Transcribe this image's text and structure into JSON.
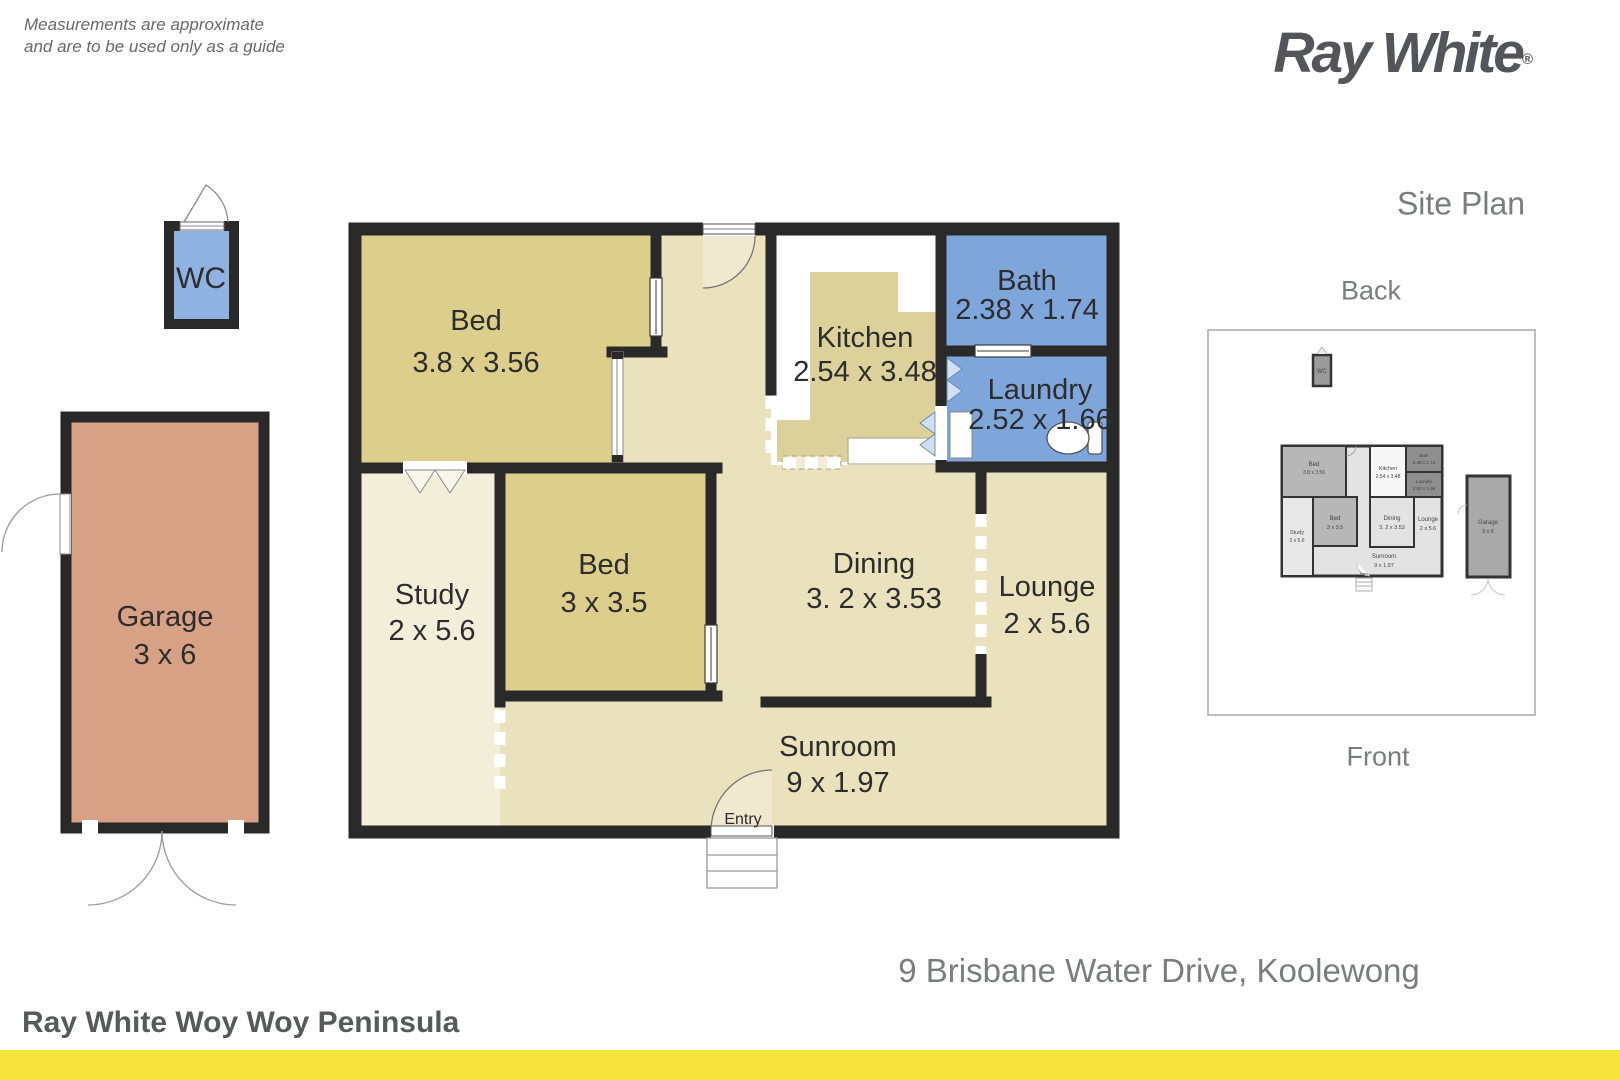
{
  "disclaimer": {
    "line1": "Measurements are approximate",
    "line2": "and are to be used only as a guide"
  },
  "brand": {
    "logo": "Ray White",
    "registered": "®"
  },
  "site_plan": {
    "title": "Site Plan",
    "back_label": "Back",
    "front_label": "Front"
  },
  "rooms": {
    "wc": {
      "name": "WC"
    },
    "garage": {
      "name": "Garage",
      "dims": "3 x 6"
    },
    "bed1": {
      "name": "Bed",
      "dims": "3.8 x 3.56"
    },
    "kitchen": {
      "name": "Kitchen",
      "dims": "2.54 x 3.48"
    },
    "bath": {
      "name": "Bath",
      "dims": "2.38 x 1.74"
    },
    "laundry": {
      "name": "Laundry",
      "dims": "2.52 x 1.66"
    },
    "study": {
      "name": "Study",
      "dims": "2 x 5.6"
    },
    "bed2": {
      "name": "Bed",
      "dims": "3 x 3.5"
    },
    "dining": {
      "name": "Dining",
      "dims": "3. 2 x 3.53"
    },
    "lounge": {
      "name": "Lounge",
      "dims": "2 x 5.6"
    },
    "sunroom": {
      "name": "Sunroom",
      "dims": "9 x 1.97"
    },
    "entry": {
      "name": "Entry"
    }
  },
  "footer": {
    "address": "9 Brisbane Water Drive, Koolewong",
    "agency": "Ray White Woy Woy Peninsula"
  },
  "colors": {
    "wall": "#292929",
    "tan_dark": "#dccf8c",
    "tan_light": "#eae1bd",
    "cream": "#f3eed9",
    "blue": "#7ea6db",
    "wc_blue": "#8fb2e2",
    "garage_salmon": "#d7a185",
    "brand_yellow": "#f7e43b",
    "gray_text": "#7b7c7e",
    "logo_gray": "#54555a"
  }
}
